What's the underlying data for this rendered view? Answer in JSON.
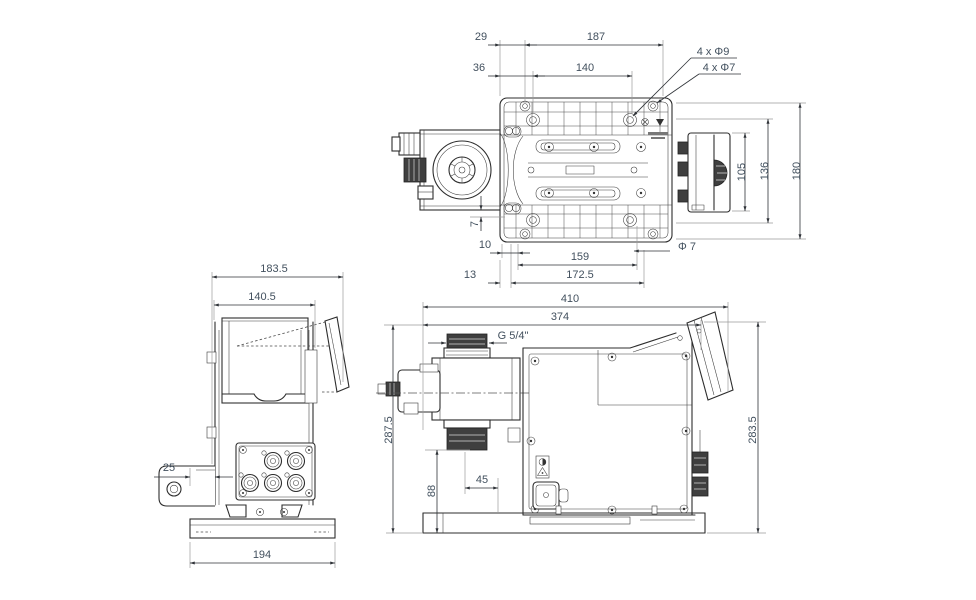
{
  "drawing": {
    "kind": "technical dimensional drawing, three orthographic views of a dosing pump",
    "background": "#ffffff",
    "line_color": "#2d2d2d",
    "dim_text_color": "#42505e"
  },
  "labels": {
    "top": {
      "d29": "29",
      "d187": "187",
      "d36": "36",
      "d140": "140",
      "holes9": "4 x Φ9",
      "holes7": "4 x Φ7",
      "d105": "105",
      "d136": "136",
      "d180": "180",
      "d7": "7",
      "d10": "10",
      "d159": "159",
      "d172_5": "172.5",
      "d13": "13",
      "phi7_note": "Φ 7"
    },
    "front": {
      "d183_5": "183.5",
      "d140_5": "140.5",
      "d25": "25",
      "d194": "194"
    },
    "side": {
      "d410": "410",
      "d374": "374",
      "thread": "G 5/4\"",
      "d287_5": "287.5",
      "d88": "88",
      "d45": "45",
      "d283_5": "283.5"
    }
  }
}
